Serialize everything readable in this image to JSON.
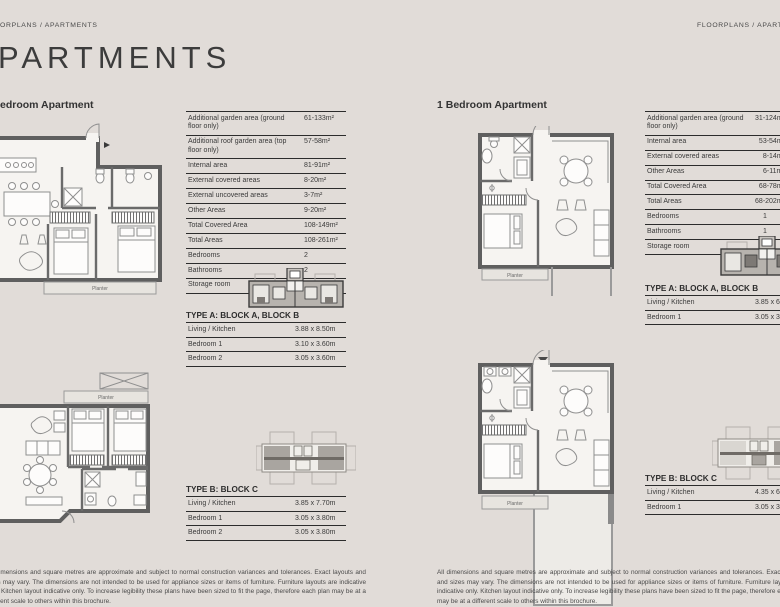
{
  "page": {
    "breadcrumb_left": "ORPLANS / APARTMENTS",
    "breadcrumb_right": "FLOORPLANS / APARTMENTS",
    "title": "PARTMENTS"
  },
  "left": {
    "heading": "edroom Apartment",
    "spec_table": {
      "rows": [
        {
          "label": "Additional garden area (ground floor only)",
          "value": "61-133m²"
        },
        {
          "label": "Additional roof garden area (top floor only)",
          "value": "57-58m²"
        },
        {
          "label": "Internal area",
          "value": "81-91m²"
        },
        {
          "label": "External covered areas",
          "value": "8-20m²"
        },
        {
          "label": "External uncovered areas",
          "value": "3-7m²"
        },
        {
          "label": "Other Areas",
          "value": "9-20m²"
        },
        {
          "label": "Total Covered Area",
          "value": "108-149m²"
        },
        {
          "label": "Total Areas",
          "value": "108-261m²"
        },
        {
          "label": "Bedrooms",
          "value": "2"
        },
        {
          "label": "Bathrooms",
          "value": "2"
        },
        {
          "label": "Storage room",
          "value": "1"
        }
      ]
    },
    "type_a": {
      "heading": "TYPE A: BLOCK A, BLOCK B",
      "rows": [
        {
          "label": "Living / Kitchen",
          "value": "3.88 x 8.50m"
        },
        {
          "label": "Bedroom 1",
          "value": "3.10 x 3.60m"
        },
        {
          "label": "Bedroom 2",
          "value": "3.05 x 3.60m"
        }
      ]
    },
    "type_b": {
      "heading": "TYPE B: BLOCK C",
      "rows": [
        {
          "label": "Living / Kitchen",
          "value": "3.85 x 7.70m"
        },
        {
          "label": "Bedroom 1",
          "value": "3.05 x 3.80m"
        },
        {
          "label": "Bedroom 2",
          "value": "3.05 x 3.80m"
        }
      ]
    }
  },
  "right": {
    "heading": "1 Bedroom Apartment",
    "spec_table": {
      "rows": [
        {
          "label": "Additional garden area (ground floor only)",
          "value": "31-124m²"
        },
        {
          "label": "Internal area",
          "value": "53-54m²"
        },
        {
          "label": "External covered areas",
          "value": "8-14m²"
        },
        {
          "label": "Other Areas",
          "value": "6-11m²"
        },
        {
          "label": "Total Covered Area",
          "value": "68-78m²"
        },
        {
          "label": "Total Areas",
          "value": "68-202m²"
        },
        {
          "label": "Bedrooms",
          "value": "1"
        },
        {
          "label": "Bathrooms",
          "value": "1"
        },
        {
          "label": "Storage room",
          "value": "1"
        }
      ]
    },
    "type_a": {
      "heading": "TYPE A: BLOCK A, BLOCK B",
      "rows": [
        {
          "label": "Living / Kitchen",
          "value": "3.85 x 6."
        },
        {
          "label": "Bedroom 1",
          "value": "3.05 x 3."
        }
      ]
    },
    "type_b": {
      "heading": "TYPE B: BLOCK C",
      "rows": [
        {
          "label": "Living / Kitchen",
          "value": "4.35 x 6."
        },
        {
          "label": "Bedroom 1",
          "value": "3.05 x 3."
        }
      ]
    }
  },
  "plans": {
    "planter_label": "Planter"
  },
  "footer": {
    "disclaimer": "All dimensions and square metres are approximate and subject to normal construction variances and tolerances. Exact layouts and sizes may vary. The dimensions are not intended to be used for appliance sizes or items of furniture. Furniture layouts are indicative only. Kitchen layout indicative only. To increase legibility these plans have been sized to fit the page, therefore each plan may be at a different scale to others within this brochure."
  },
  "colors": {
    "background": "#e1dcd8",
    "wall": "#5f5f5f",
    "text": "#3f3f3f",
    "rule": "#2c2c2c"
  }
}
